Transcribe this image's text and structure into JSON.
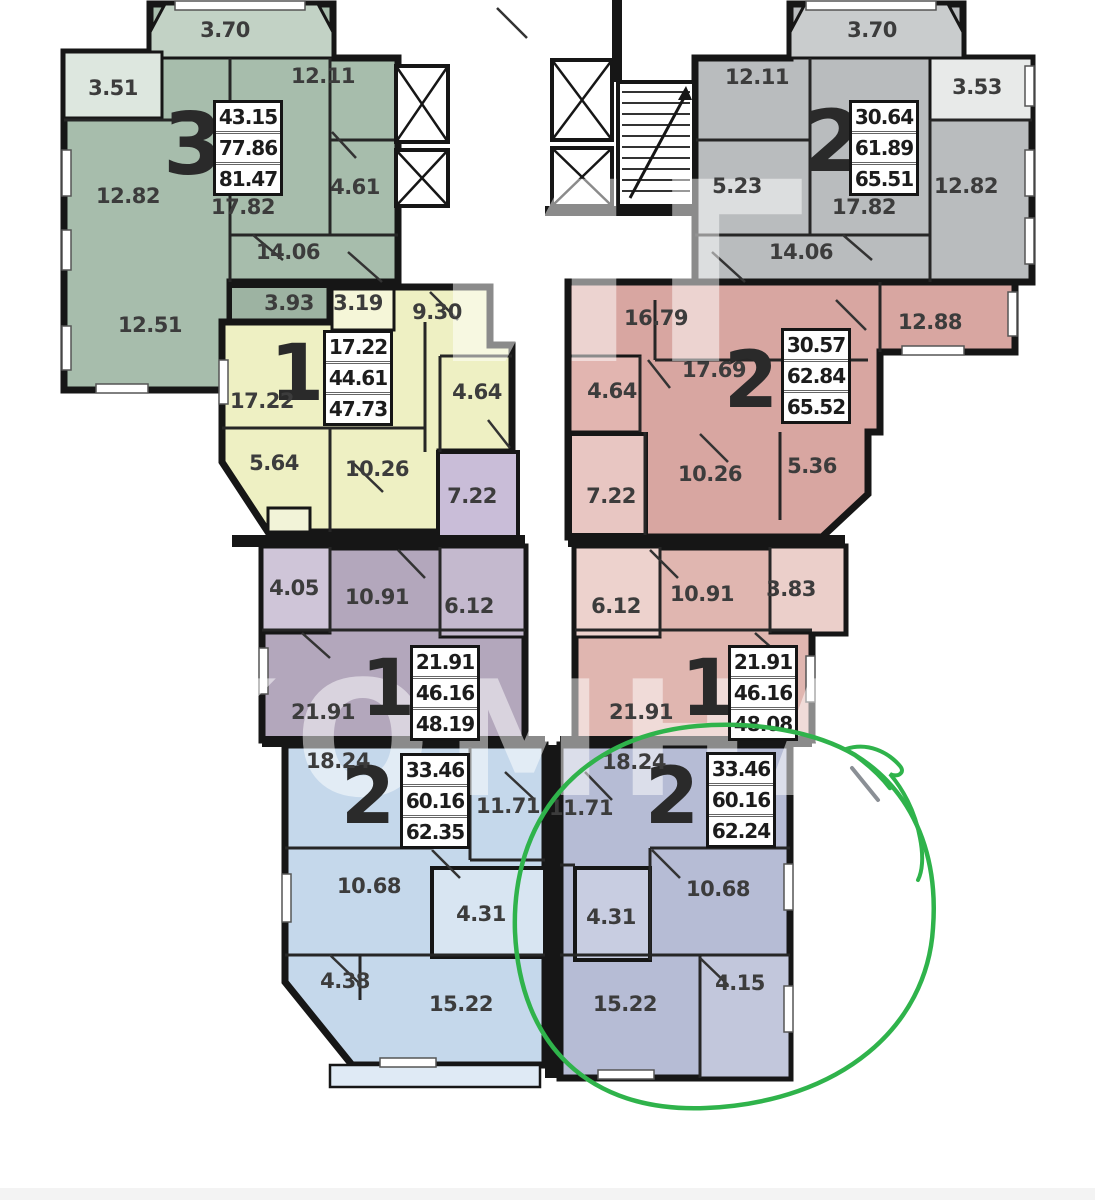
{
  "floorplan": {
    "highlight_circle": {
      "color": "#2fb34b",
      "around_apartment": "two-room-bottom-right-62.24"
    },
    "watermark": {
      "top": "ИГ",
      "bottom": "КОМНАТ"
    },
    "apartments": [
      {
        "name": "three-room-top-left",
        "type_label": "3",
        "color": "#a7bdac",
        "stats": {
          "v1": "43.15",
          "v2": "77.86",
          "v3": "81.47"
        },
        "rooms": [
          {
            "area": "3.70"
          },
          {
            "area": "3.51"
          },
          {
            "area": "12.11"
          },
          {
            "area": "12.82"
          },
          {
            "area": "4.61"
          },
          {
            "area": "17.82"
          },
          {
            "area": "14.06"
          },
          {
            "area": "12.51"
          },
          {
            "area": "3.93"
          }
        ]
      },
      {
        "name": "two-room-top-right",
        "type_label": "2",
        "color": "#b9bcbe",
        "stats": {
          "v1": "30.64",
          "v2": "61.89",
          "v3": "65.51"
        },
        "rooms": [
          {
            "area": "3.70"
          },
          {
            "area": "12.11"
          },
          {
            "area": "3.53"
          },
          {
            "area": "5.23"
          },
          {
            "area": "17.82"
          },
          {
            "area": "12.82"
          },
          {
            "area": "14.06"
          }
        ]
      },
      {
        "name": "one-room-mid-left",
        "type_label": "1",
        "color": "#eef0c3",
        "stats": {
          "v1": "17.22",
          "v2": "44.61",
          "v3": "47.73"
        },
        "rooms": [
          {
            "area": "3.19"
          },
          {
            "area": "9.30"
          },
          {
            "area": "17.22"
          },
          {
            "area": "4.64"
          },
          {
            "area": "5.64"
          },
          {
            "area": "10.26"
          }
        ]
      },
      {
        "name": "two-room-mid-right",
        "type_label": "2",
        "color": "#d8a6a1",
        "stats": {
          "v1": "30.57",
          "v2": "62.84",
          "v3": "65.52"
        },
        "rooms": [
          {
            "area": "16.79"
          },
          {
            "area": "12.88"
          },
          {
            "area": "17.69"
          },
          {
            "area": "4.64"
          },
          {
            "area": "10.26"
          },
          {
            "area": "5.36"
          },
          {
            "area": "7.22"
          }
        ]
      },
      {
        "name": "one-room-lower-left",
        "type_label": "1",
        "color": "#b3a7bc",
        "stats": {
          "v1": "21.91",
          "v2": "46.16",
          "v3": "48.19"
        },
        "rooms": [
          {
            "area": "4.05"
          },
          {
            "area": "10.91"
          },
          {
            "area": "6.12"
          },
          {
            "area": "21.91"
          },
          {
            "area": "7.22"
          }
        ]
      },
      {
        "name": "one-room-lower-right",
        "type_label": "1",
        "color": "#e0b6b0",
        "stats": {
          "v1": "21.91",
          "v2": "46.16",
          "v3": "48.08"
        },
        "rooms": [
          {
            "area": "6.12"
          },
          {
            "area": "10.91"
          },
          {
            "area": "3.83"
          },
          {
            "area": "21.91"
          }
        ]
      },
      {
        "name": "two-room-bottom-left",
        "type_label": "2",
        "color": "#c5d8eb",
        "stats": {
          "v1": "33.46",
          "v2": "60.16",
          "v3": "62.35"
        },
        "rooms": [
          {
            "area": "18.24"
          },
          {
            "area": "11.71"
          },
          {
            "area": "10.68"
          },
          {
            "area": "4.31"
          },
          {
            "area": "4.38"
          },
          {
            "area": "15.22"
          }
        ]
      },
      {
        "name": "two-room-bottom-right-highlighted",
        "type_label": "2",
        "color": "#b6bcd5",
        "stats": {
          "v1": "33.46",
          "v2": "60.16",
          "v3": "62.24"
        },
        "rooms": [
          {
            "area": "18.24"
          },
          {
            "area": "11.71"
          },
          {
            "area": "10.68"
          },
          {
            "area": "4.31"
          },
          {
            "area": "4.15"
          },
          {
            "area": "15.22"
          }
        ]
      }
    ]
  }
}
